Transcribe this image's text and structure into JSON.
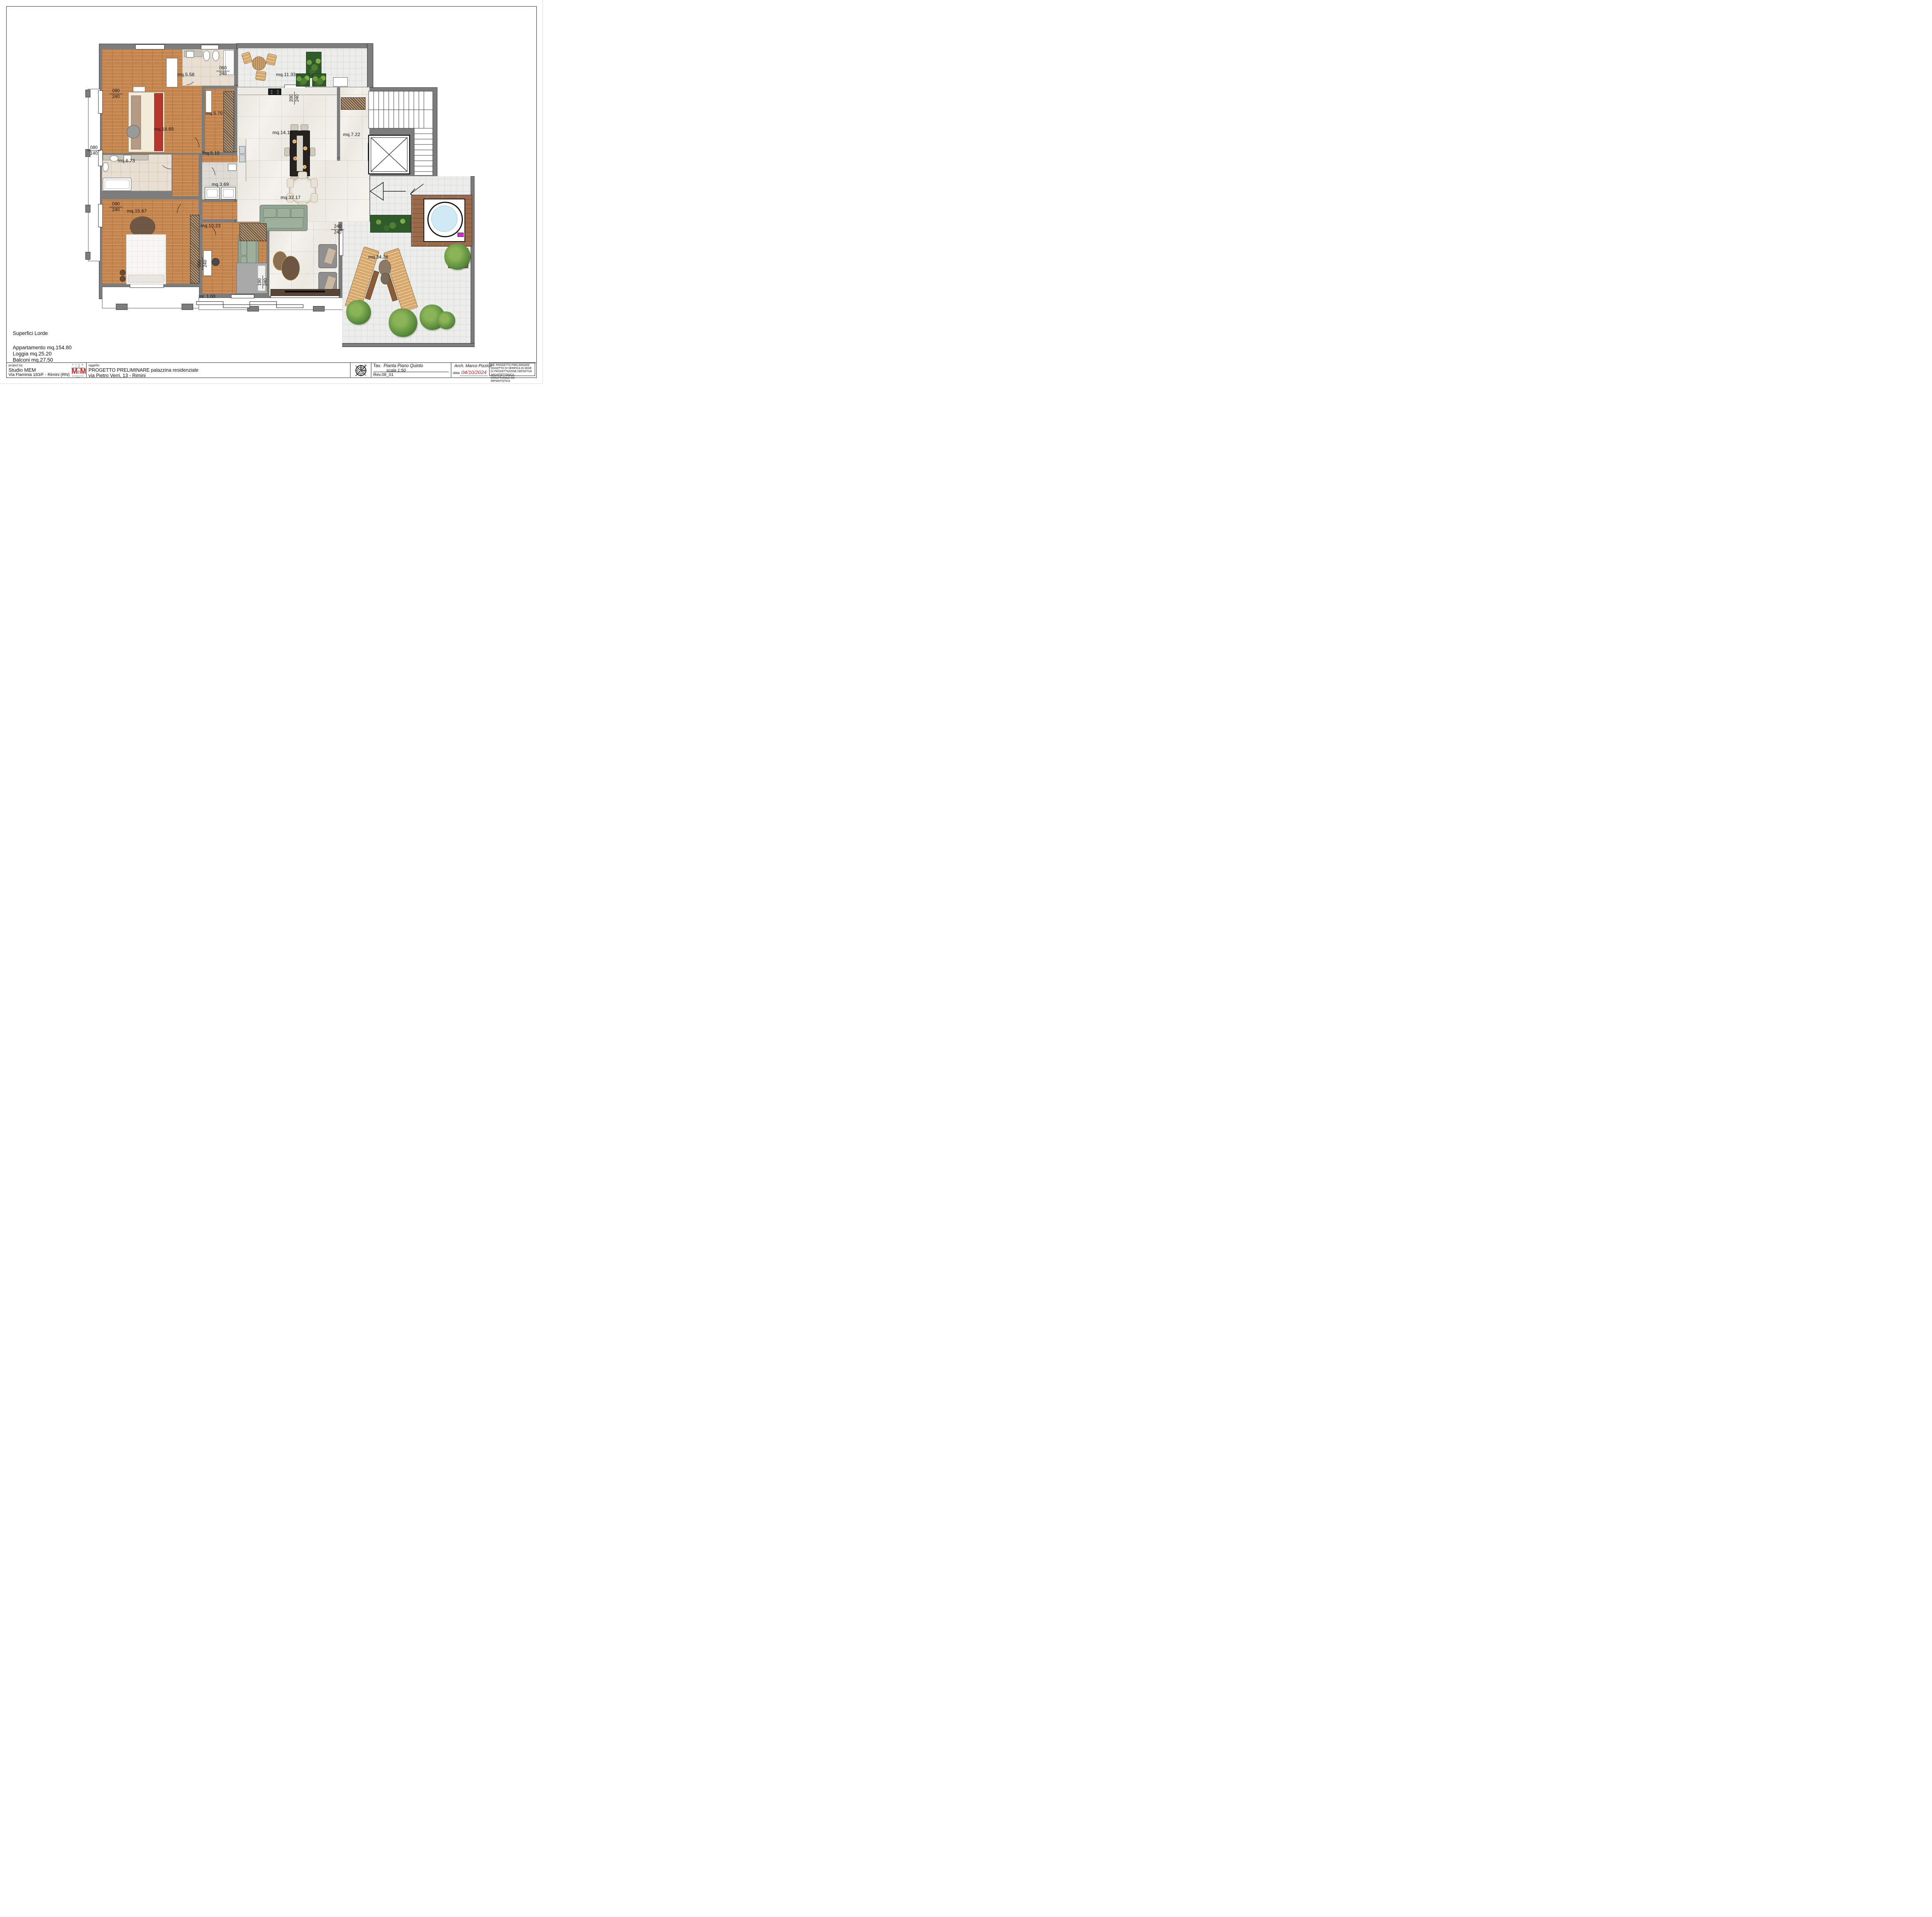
{
  "sheet": {
    "summary": {
      "title": "Superfici Lorde",
      "items": [
        "Appartamento mq.154.80",
        "Loggia mq.25.20",
        "Balconi mq.27.50"
      ]
    },
    "scale_bar": {
      "label": "mt. 1.00"
    },
    "rooms": [
      {
        "id": "master-bedroom",
        "label": "mq.18.65"
      },
      {
        "id": "bathroom-main",
        "label": "mq.5.58"
      },
      {
        "id": "corridor",
        "label": "mq.5.70"
      },
      {
        "id": "terrace-north",
        "label": "mq.11.33"
      },
      {
        "id": "kitchen-dining",
        "label": "mq.14.13"
      },
      {
        "id": "entry-hall",
        "label": "mq.7.22"
      },
      {
        "id": "bathroom-second",
        "label": "mq.6.73"
      },
      {
        "id": "hallway",
        "label": "mq.5.15"
      },
      {
        "id": "laundry",
        "label": "mq.3.69"
      },
      {
        "id": "living-room",
        "label": "mq.32.17"
      },
      {
        "id": "bedroom-second",
        "label": "mq.15.67"
      },
      {
        "id": "bedroom-third",
        "label": "mq.10.23"
      },
      {
        "id": "terrace-south",
        "label": "mq.34.26"
      }
    ],
    "dims": [
      {
        "num": "090",
        "den": "240"
      },
      {
        "num": "060",
        "den": "240"
      },
      {
        "num": "200",
        "den": "240"
      },
      {
        "num": "080",
        "den": "140"
      },
      {
        "num": "090",
        "den": "240"
      },
      {
        "num": "240",
        "den": "240"
      },
      {
        "num": "090",
        "den": "240"
      },
      {
        "num": "190",
        "den": "240"
      }
    ],
    "title_block": {
      "project_by_label": "project by",
      "studio_name": "Studio MEM",
      "studio_address": "Via Flaminia 183/F   - Rimini (RN)",
      "logo_studio": "S T U D I O",
      "logo_m1": "M",
      "logo_e": "e",
      "logo_m2": "M",
      "logo_sub": "Architectural Lab",
      "object_label": "oggetto",
      "object_line1": "PROGETTO PRELIMINARE palazzina residenziale",
      "object_line2": "via Pietro Verri, 13 - Rimini",
      "sheet_title_label": "Tav.",
      "sheet_title": "Pianta Piano Quinto",
      "sheet_scale": "scala 1:50",
      "revision": "Rev.08_01",
      "architect": "Arch. Marco Pizzioli",
      "date_label": "data",
      "date_value": "04/10/2024",
      "note": "NB: PROGETTO PRELIMINARE OGGETTO DI VERIFICA IN SEDE DI PROGETTAZIONE DEFINITIVA ARCHITETTONICA, STRUTTURALE ED IMPIANTISTICA"
    },
    "colors": {
      "wall": "#7d7d7d",
      "wood_floor": "#c5874f",
      "deck_wood": "#9a6a4a",
      "marble": "#f4f2ed",
      "sofa_green": "#93a393",
      "bed_red": "#b5372c",
      "date_red": "#e02020",
      "logo_red": "#d42020",
      "water_blue": "#cfeaf4"
    }
  }
}
